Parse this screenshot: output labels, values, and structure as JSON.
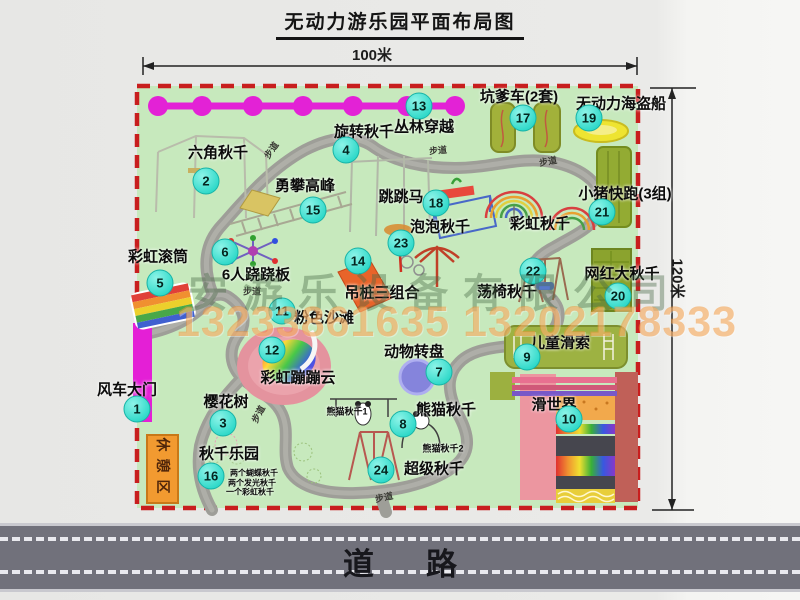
{
  "title": "无动力游乐园平面布局图",
  "dimensions": {
    "width_label": "100米",
    "height_label": "120米"
  },
  "road": {
    "label": "道路"
  },
  "watermark": {
    "company": "安游乐设备有限公司",
    "phone": "13233861635 13202178333"
  },
  "rest_area": {
    "label": "休憩区"
  },
  "walkway": {
    "label": "步道"
  },
  "colors": {
    "park_green": "#c7e9bd",
    "border_red": "#c81e1e",
    "badge_teal": "#2fd9c9",
    "magenta_line": "#e322d6",
    "path_gray": "#9e9e98",
    "road_gray": "#71717b",
    "rest_orange": "#f29a30",
    "watermark_orange": "#f2963a"
  },
  "map": {
    "items": [
      {
        "num": "1",
        "label": "风车大门",
        "lx": 127,
        "ly": 389,
        "bx": 137,
        "by": 409
      },
      {
        "num": "2",
        "label": "六角秋千",
        "lx": 218,
        "ly": 152,
        "bx": 206,
        "by": 181
      },
      {
        "num": "3",
        "label": "樱花树",
        "lx": 226,
        "ly": 401,
        "bx": 223,
        "by": 423
      },
      {
        "num": "4",
        "label": "旋转秋千",
        "lx": 364,
        "ly": 131,
        "bx": 346,
        "by": 150
      },
      {
        "num": "5",
        "label": "彩虹滚筒",
        "lx": 158,
        "ly": 256,
        "bx": 160,
        "by": 283
      },
      {
        "num": "6",
        "label": "6人跷跷板",
        "lx": 256,
        "ly": 274,
        "bx": 225,
        "by": 252
      },
      {
        "num": "7",
        "label": "动物转盘",
        "lx": 414,
        "ly": 351,
        "bx": 439,
        "by": 372
      },
      {
        "num": "8",
        "label": "熊猫秋千",
        "lx": 446,
        "ly": 409,
        "bx": 403,
        "by": 424
      },
      {
        "num": "9",
        "label": "儿童滑索",
        "lx": 560,
        "ly": 342,
        "bx": 527,
        "by": 357
      },
      {
        "num": "10",
        "label": "滑世界",
        "lx": 554,
        "ly": 404,
        "bx": 569,
        "by": 419
      },
      {
        "num": "11",
        "label": "粉色沙滩",
        "lx": 324,
        "ly": 317,
        "bx": 282,
        "by": 311
      },
      {
        "num": "12",
        "label": "彩虹蹦蹦云",
        "lx": 298,
        "ly": 377,
        "bx": 272,
        "by": 350
      },
      {
        "num": "13",
        "label": "丛林穿越",
        "lx": 424,
        "ly": 126,
        "bx": 419,
        "by": 106
      },
      {
        "num": "14",
        "label": "吊桩三组合",
        "lx": 382,
        "ly": 292,
        "bx": 358,
        "by": 261
      },
      {
        "num": "15",
        "label": "勇攀高峰",
        "lx": 305,
        "ly": 185,
        "bx": 313,
        "by": 210
      },
      {
        "num": "16",
        "label": "秋千乐园",
        "lx": 229,
        "ly": 453,
        "bx": 211,
        "by": 476
      },
      {
        "num": "17",
        "label": "坑爹车(2套)",
        "lx": 519,
        "ly": 96,
        "bx": 523,
        "by": 118
      },
      {
        "num": "18",
        "label": "跳跳马",
        "lx": 401,
        "ly": 196,
        "bx": 436,
        "by": 203
      },
      {
        "num": "19",
        "label": "无动力海盗船",
        "lx": 621,
        "ly": 103,
        "bx": 589,
        "by": 118
      },
      {
        "num": "20",
        "label": "网红大秋千",
        "lx": 622,
        "ly": 273,
        "bx": 618,
        "by": 296
      },
      {
        "num": "21",
        "label": "小猪快跑(3组)",
        "lx": 625,
        "ly": 193,
        "bx": 602,
        "by": 212
      },
      {
        "num": "22",
        "label": "荡椅秋千",
        "lx": 507,
        "ly": 291,
        "bx": 533,
        "by": 271
      },
      {
        "num": "23",
        "label": "泡泡秋千",
        "lx": 440,
        "ly": 226,
        "bx": 401,
        "by": 243
      },
      {
        "num": "24",
        "label": "超级秋千",
        "lx": 434,
        "ly": 468,
        "bx": 381,
        "by": 470
      }
    ],
    "notes": [
      {
        "label": "彩虹秋千",
        "x": 540,
        "y": 223,
        "size": 15
      },
      {
        "label": "熊猫秋千1",
        "x": 347,
        "y": 411,
        "size": 9
      },
      {
        "label": "熊猫秋千2",
        "x": 443,
        "y": 448,
        "size": 9
      },
      {
        "label": "两个蝴蝶秋千",
        "x": 254,
        "y": 473,
        "size": 8
      },
      {
        "label": "两个发光秋千",
        "x": 252,
        "y": 483,
        "size": 8
      },
      {
        "label": "一个彩虹秋千",
        "x": 250,
        "y": 492,
        "size": 8
      }
    ]
  }
}
